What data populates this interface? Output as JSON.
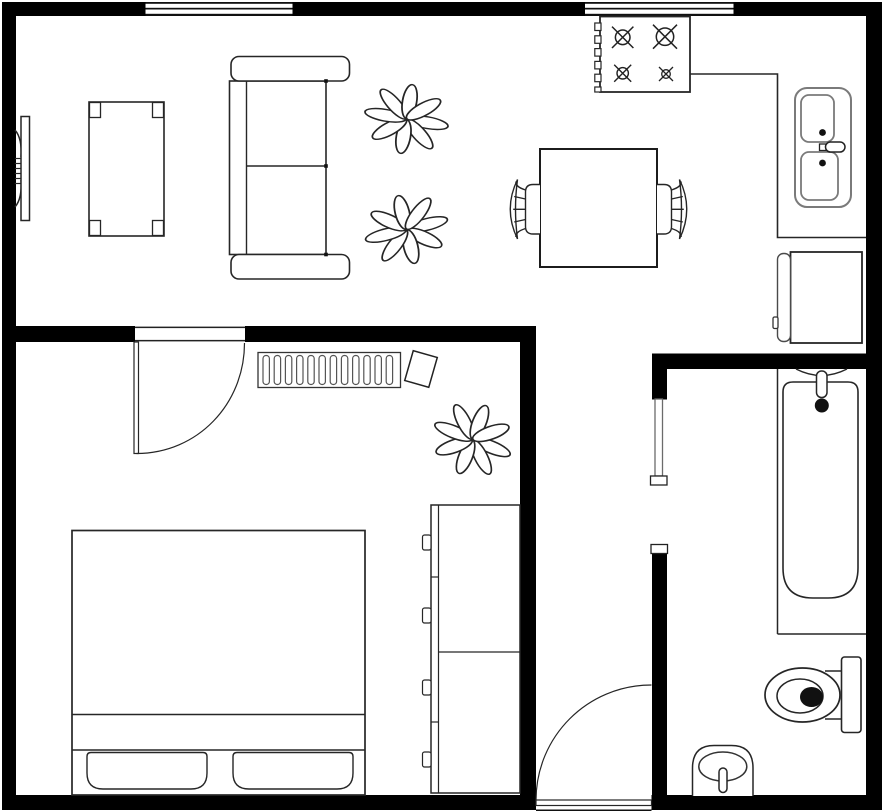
{
  "canvas": {
    "width": 884,
    "height": 812,
    "background": "#ffffff"
  },
  "palette": {
    "wall": "#000000",
    "outline": "#262626",
    "fixture_gray": "#7a7a7a",
    "fill": "#ffffff"
  },
  "rooms": [
    {
      "id": "living-room",
      "label": "Living Room",
      "furniture": [
        "wall-tv",
        "coffee-table",
        "sofa",
        "plant",
        "plant"
      ]
    },
    {
      "id": "kitchen",
      "label": "Kitchen",
      "furniture": [
        "stove",
        "counter",
        "double-sink",
        "refrigerator"
      ]
    },
    {
      "id": "dining-area",
      "label": "Dining Area",
      "furniture": [
        "dining-table",
        "dining-chair-left",
        "dining-chair-right"
      ]
    },
    {
      "id": "bedroom",
      "label": "Bedroom",
      "furniture": [
        "bedroom-door",
        "clothes-rack",
        "plant",
        "bed",
        "dresser"
      ]
    },
    {
      "id": "hallway",
      "label": "Hallway",
      "furniture": [
        "entry-door"
      ]
    },
    {
      "id": "bathroom",
      "label": "Bathroom",
      "furniture": [
        "sliding-door",
        "bathtub",
        "tub-faucet",
        "toilet",
        "pedestal-sink"
      ]
    }
  ],
  "labels": {
    "floor_plan": "Apartment floor plan",
    "walls": "Walls",
    "window1": "Window",
    "window2": "Window",
    "tv": "Wall-mounted TV",
    "coffee_table": "Coffee table",
    "sofa": "Sofa",
    "plant1": "Plant",
    "plant2": "Plant",
    "plant3": "Plant",
    "stove": "Stove with 4 burners",
    "counter": "Kitchen counter",
    "kitchen_sink": "Double kitchen sink",
    "fridge": "Refrigerator",
    "dining_table": "Dining table",
    "chair_left": "Dining chair",
    "chair_right": "Dining chair",
    "bedroom_door": "Bedroom door",
    "clothes_rack": "Clothes rack",
    "bed": "Double bed with pillows",
    "dresser": "Dresser",
    "entry_door": "Entry door",
    "sliding_door": "Bathroom door",
    "bathtub": "Bathtub",
    "toilet": "Toilet",
    "bath_sink": "Pedestal sink"
  }
}
